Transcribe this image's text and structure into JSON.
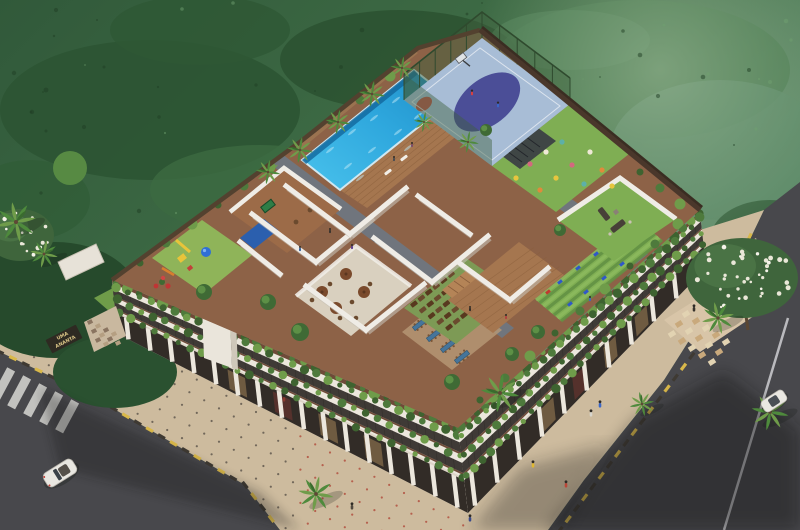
{
  "scene": {
    "type": "aerial architectural 3D render",
    "description": "Bird's-eye view of a low-rise mixed-use building with a landscaped rooftop amenity deck, set against dense green forest, with an asphalt road and zebra crossing at lower-left, a second road along the right, beige paved sidewalks with red dot pattern, palm trees and pedestrians.",
    "signs": {
      "building_line1": "UMA",
      "building_line2": "ANANTA",
      "gate_sign": "UMA ANANTA"
    },
    "building": {
      "facade": "white fascia bands alternating with dark balcony railings, bronze-brown trims and cascading green planters; ground-floor retail arcade with tall white columns and warm lit shopfronts",
      "rooftop_amenities": [
        "infinity swimming pool with timber sun deck",
        "fenced multi-sport court with basketball hoop and purple centre circle",
        "bean-bag lounge lawn with dark pergola",
        "walled sofa lounge on grass",
        "outdoor gym with blue equipment on striped turf",
        "timber exercise deck with steps",
        "open-air amphitheatre rows of brown seats",
        "rooftop cafe with parasol tables",
        "dining terrace with long blue tables",
        "games room with green pool table and blue canopy",
        "children's playground with slides and dome climber",
        "open-air white partition rooms",
        "grey tiled walkways, hedges and roof-edge palms"
      ]
    },
    "site": [
      "zebra pedestrian crossing on the lower-left road",
      "white lane line on the right road",
      "beige sidewalk paving with red dot grid and yellow-black kerb blocks",
      "compound entrance gate with name board and checkered driveway",
      "white flowering trees beside the gate and at the left edge",
      "street palm trees casting soft shadows",
      "long building shadow across both roads"
    ],
    "vehicles": [
      "white open-top car driving on the left road",
      "white car on the right road"
    ],
    "people": "pedestrians on the pavements, players on the sports court, people around the pool, gym and lawns"
  },
  "palette": {
    "forest1": "#35603a",
    "forest2": "#7ca486",
    "forestDark": "#2c5433",
    "forestLight": "#5d8a68",
    "road": "#48484c",
    "roadHi": "#56565b",
    "sidewalk": "#cdbb9e",
    "sidewalkDot": "#b04a3a",
    "curbY": "#d9b84a",
    "curbD": "#3f3a33",
    "white": "#ece7dd",
    "cream": "#ddd5c8",
    "bandBrown": "#6e4a38",
    "bandDark": "#3f3a36",
    "shop": "#322c27",
    "glow": "#caa36a",
    "plant1": "#4e7a3c",
    "plant2": "#6f9c4a",
    "plant3": "#3e6330",
    "deckBrown": "#8d6247",
    "wood": "#a5764f",
    "woodLine": "#8a5f3c",
    "walkGray": "#70757d",
    "wallWhite": "#efece6",
    "wallShadow": "#c6c0b5",
    "lawn": "#7fae53",
    "lawnDark": "#639244",
    "poolLight": "#56c8ee",
    "pool": "#2ea7dd",
    "poolDeep": "#1576ad",
    "court": "#a8bdd6",
    "courtPurple": "#4b4e97",
    "courtRed": "#c2483a",
    "fence": "#3f5f3d",
    "parapet": "#53412f",
    "neWall": "#3a2d22",
    "shadow": "#141914",
    "carWhite": "#e9e7e1",
    "signBg": "#2e2a22",
    "signText": "#d9c486",
    "skin": "#e8c9a0"
  }
}
